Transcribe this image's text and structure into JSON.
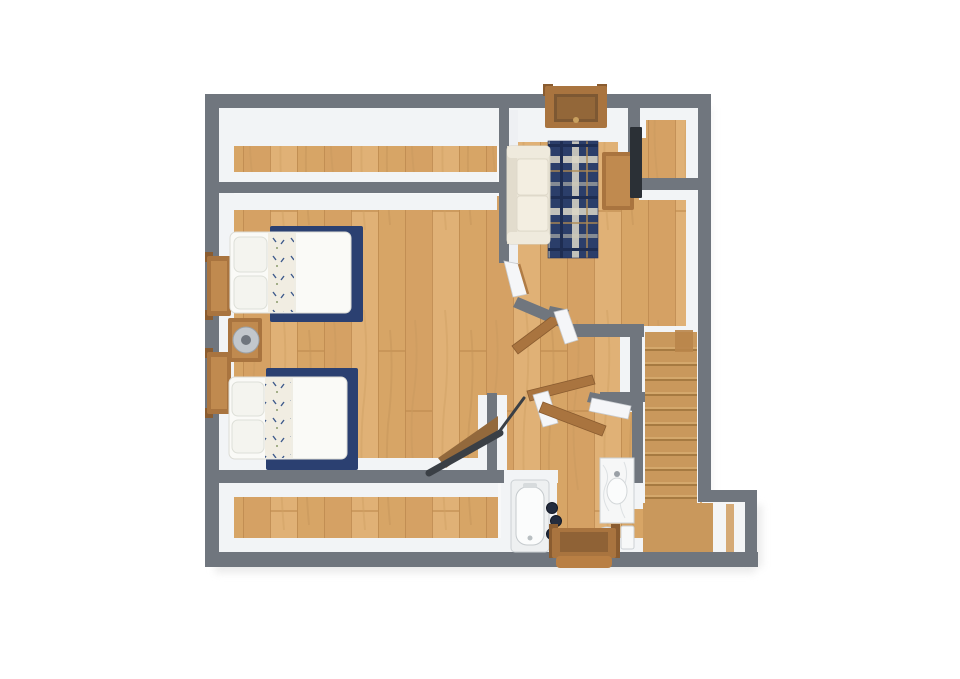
{
  "scene": {
    "kind": "floor-plan-3d-top-view",
    "rooms": [
      "upper-closet-strip",
      "living-area",
      "bedroom",
      "lower-closet-strip",
      "bathroom",
      "stair-hall",
      "entry-nook"
    ],
    "furniture": [
      "sofa",
      "plaid-area-rug",
      "tv",
      "tv-stand",
      "dresser",
      "double-bed",
      "double-bed",
      "navy-area-rug",
      "navy-area-rug",
      "nightstand",
      "table-lamp",
      "staircase",
      "handrail",
      "bathtub",
      "towel-stack",
      "sink-vanity",
      "toilet",
      "entry-door",
      "interior-door",
      "interior-door",
      "interior-door"
    ]
  },
  "colors": {
    "background": "#ffffff",
    "wall": "#70767e",
    "wall_face": "#f2f4f6",
    "floor_wood": "#d9a86c",
    "stair_wood": "#c9985c",
    "rug_navy": "#2b4071",
    "couch_cream": "#eae5d7",
    "bedding_white": "#fafaf7",
    "furniture_wood": "#a9743f",
    "furniture_wood_light": "#c08a4f",
    "tv_black": "#2b3036",
    "fixture_white": "#fbfcfc",
    "fixture_outline": "#ccd1d4",
    "railing_dark": "#3a3f45",
    "shadow": "#e4e4e4"
  }
}
